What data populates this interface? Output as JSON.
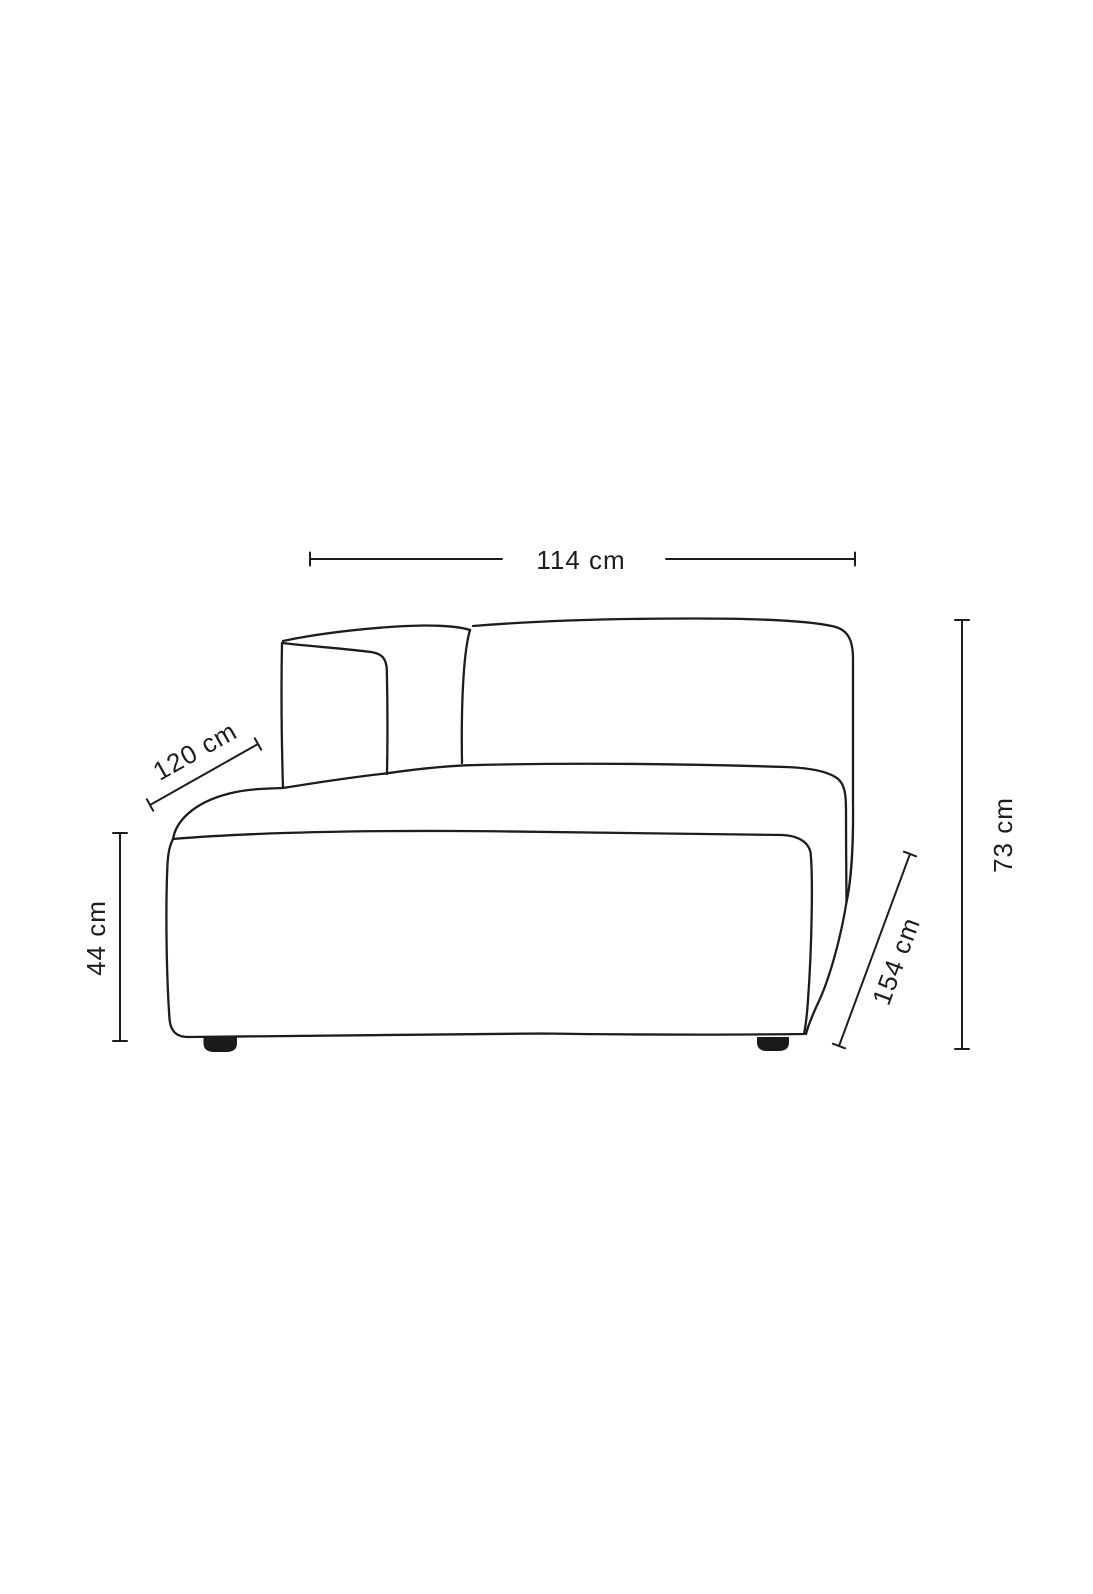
{
  "page": {
    "background_color": "#ffffff"
  },
  "diagram": {
    "kind": "product-dimension-line-drawing",
    "subject": "modular-sofa-chaise-element-with-left-backrest",
    "line_color": "#1d1d1b",
    "foot_color": "#1a1a18",
    "dimensions": {
      "top_width": "114 cm",
      "back_depth": "120 cm",
      "seat_height": "44 cm",
      "total_depth": "154 cm",
      "total_height": "73 cm"
    }
  }
}
